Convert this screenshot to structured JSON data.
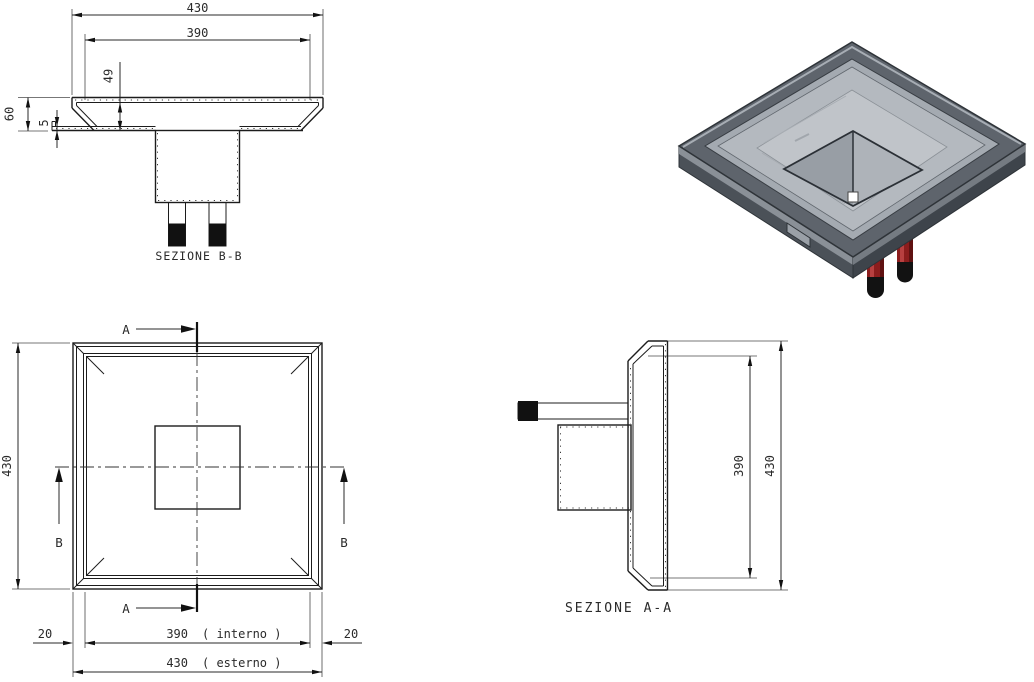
{
  "canvas": {
    "background": "#ffffff",
    "line_color": "#1c1c1c"
  },
  "section_bb": {
    "label": "SEZIONE  B-B",
    "dim_outer_width": "430",
    "dim_inner_width": "390",
    "dim_depth": "49",
    "dim_height": "60",
    "dim_flange_thickness": "5"
  },
  "plan": {
    "dim_side": "430",
    "dim_margin_left": "20",
    "dim_margin_right": "20",
    "dim_inner_value": "390",
    "dim_inner_suffix": "( interno )",
    "dim_outer_value": "430",
    "dim_outer_suffix": "( esterno )",
    "mark_a": "A",
    "mark_b": "B"
  },
  "section_aa": {
    "label": "SEZIONE  A-A",
    "dim_inner_height": "390",
    "dim_outer_height": "430"
  },
  "iso": {
    "colors": {
      "rim": "#5e646c",
      "ledge": "#a4aab1",
      "slope": "#b4b9bf",
      "floor": "#c0c4c9",
      "pyramid_left": "#989ea5",
      "pyramid_right": "#aeb3b9",
      "side_left": "#4b5158",
      "side_left_top": "#8a9097",
      "side_right": "#3e444b",
      "side_right_top": "#757b82",
      "tab": "#9aa0a7",
      "pipe": "#8c1d1d",
      "pipe_highlight": "#b84040",
      "pipe_shadow": "#5f1111",
      "cap": "#121212",
      "drain": "#ffffff"
    }
  }
}
